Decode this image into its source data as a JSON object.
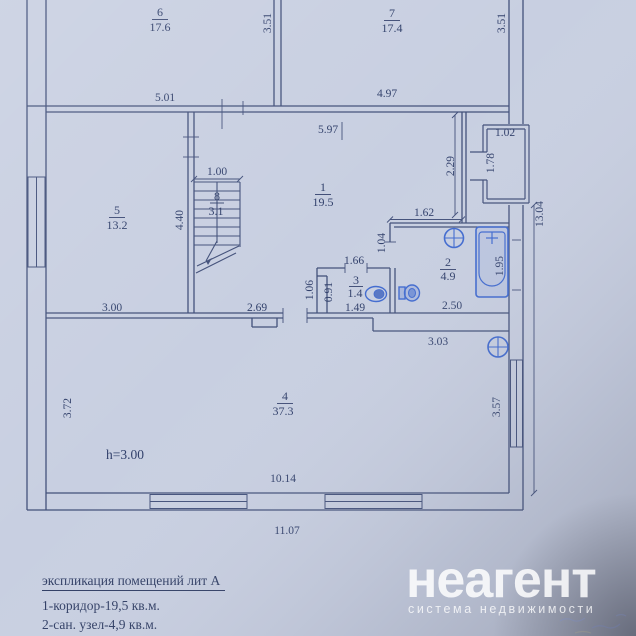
{
  "floor_plan": {
    "rooms": [
      {
        "number": "1",
        "area": "19.5"
      },
      {
        "number": "2",
        "area": "4.9"
      },
      {
        "number": "3",
        "area": "1.4"
      },
      {
        "number": "4",
        "area": "37.3"
      },
      {
        "number": "5",
        "area": "13.2"
      },
      {
        "number": "6",
        "area": "17.6"
      },
      {
        "number": "7",
        "area": "17.4"
      },
      {
        "number": "8",
        "area": "3.1"
      }
    ],
    "dimensions": {
      "room6_width": "5.01",
      "room6_depth": "3.51",
      "room7_width": "4.97",
      "room7_depth": "3.51",
      "hall_width": "5.97",
      "porch_width": "1.02",
      "porch_depth": "1.78",
      "entry_wall": "2.29",
      "right_side_total": "13.04",
      "stairs_width": "1.00",
      "stairs_depth": "4.40",
      "bath_top_width": "1.62",
      "bath_door_height": "1.04",
      "wc_top_width": "1.66",
      "wc_left_outer": "1.06",
      "wc_left_inner": "0.91",
      "wc_bottom_width": "1.49",
      "bath_bottom_width": "2.50",
      "bathtub_length": "1.95",
      "room5_bottom_width": "3.00",
      "hall_bottom_width": "2.69",
      "room4_top_right_width": "3.03",
      "room4_left_depth": "3.72",
      "room4_right_depth": "3.57",
      "room4_bottom_width": "10.14",
      "building_bottom_width": "11.07",
      "ceiling_height": "h=3.00"
    }
  },
  "explication": {
    "title": "экспликация помещений лит А",
    "items": [
      "1-коридор-19,5 кв.м.",
      "2-сан. узел-4,9 кв.м."
    ]
  },
  "watermark": {
    "brand": "неагент",
    "tagline": "система недвижимости"
  },
  "colors": {
    "paper": "#c8cfe1",
    "ink": "#42507a",
    "fixture_blue": "#3f69cf",
    "height_note_blue": "#2b55c0"
  }
}
